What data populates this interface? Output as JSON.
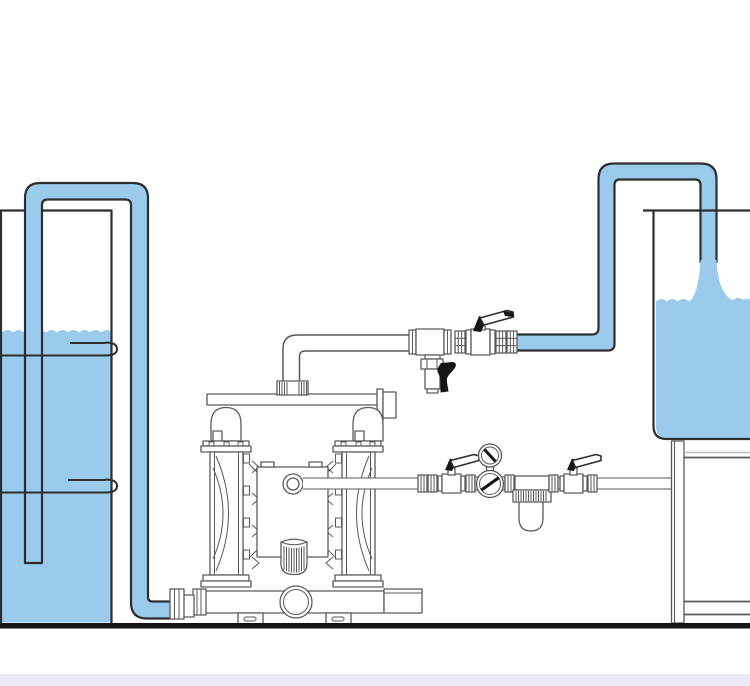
{
  "scene": {
    "description": "Technical line illustration of an air-operated double-diaphragm pump transferring liquid from a supply drum into a receiving tank on a stand",
    "canvas": {
      "width": 750,
      "height": 686
    },
    "colors": {
      "background": "#ffffff",
      "liquid": "#9acbed",
      "outline": "#2e2e2e",
      "equipment": "#5a5a5a",
      "light_line": "#bcbcbc",
      "handle": "#151515",
      "ground": "#141414",
      "footer_band": "#e8eaf4"
    }
  },
  "components": {
    "supply_drum": {
      "name": "supply-drum",
      "liquid": true,
      "rolling_hoops": 2,
      "dip_tube": true
    },
    "suction_hose": {
      "name": "suction-hose",
      "filled_with_liquid": true
    },
    "pump": {
      "name": "double-diaphragm-pump",
      "chambers": 2,
      "muffler": true,
      "feet": 2
    },
    "discharge_line": {
      "name": "discharge-line",
      "tee_with_drain_nozzle": true,
      "ball_valve": true,
      "unions": 4
    },
    "transfer_line": {
      "name": "transfer-line",
      "filled_with_liquid": true,
      "pouring": true
    },
    "receiving_tank": {
      "name": "receiving-tank",
      "on_stand": true,
      "liquid": true
    },
    "air_supply_line": {
      "name": "air-supply-line",
      "ball_valves": 2,
      "regulator_with_gauge": true,
      "filter_bowl": true
    }
  }
}
